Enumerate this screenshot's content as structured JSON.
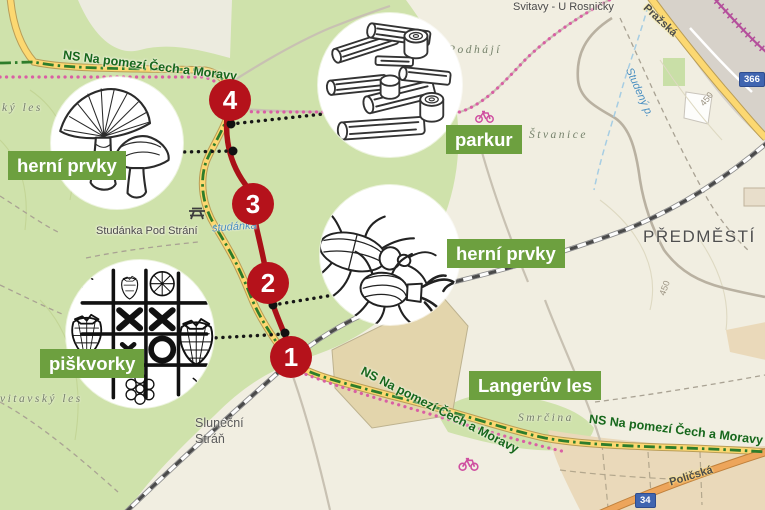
{
  "overlay": {
    "markers": [
      "4",
      "3",
      "2",
      "1"
    ],
    "labels": {
      "herni_prvky_1": "herní prvky",
      "parkur": "parkur",
      "herni_prvky_2": "herní prvky",
      "piskvorky": "piškvorky",
      "langeruv_les": "Langerův les"
    },
    "callout_icons": {
      "mushrooms": "mushrooms-illustration",
      "logs": "logs-parkour-illustration",
      "beetles": "stag-beetles-illustration",
      "tictactoe": "tictactoe-strawberries-illustration"
    }
  },
  "map": {
    "trail_label": "NS Na pomezí Čech a Moravy",
    "places": {
      "svitavy_u_rosnicky": "Svitavy - U Rosničky",
      "podhaji": "Podhájí",
      "stvanice": "Štvanice",
      "predmesti": "PŘEDMĚSTÍ",
      "studanka_pod_strani": "Studánka Pod Strání",
      "studanka_spring": "studánka",
      "studeny_potok": "Studený p.",
      "ky_les": "ký les",
      "vitavsky_les": "vitavský les",
      "slunecni_1": "Sluneční",
      "slunecni_2": "Stráň",
      "smrcina": "Smrčina"
    },
    "road_labels": {
      "prazska": "Pražská",
      "policska": "Poličská"
    },
    "road_shields": {
      "r366": "366",
      "r34": "34"
    },
    "contour_labels": {
      "a": "450",
      "b": "450"
    },
    "icons": {
      "bicycle_1": "bicycle-icon",
      "bicycle_2": "bicycle-icon",
      "picnic_table": "picnic-table-icon"
    }
  },
  "colors": {
    "label_green": "#6da03f",
    "marker_red": "#b5121b",
    "route_red": "#a91117",
    "trail_green": "#2e7d2b",
    "cycle_pink": "#d95fa4",
    "road_yellow": "#fcd871",
    "forest_green": "#cfe2ab",
    "background": "#f1eee1"
  }
}
